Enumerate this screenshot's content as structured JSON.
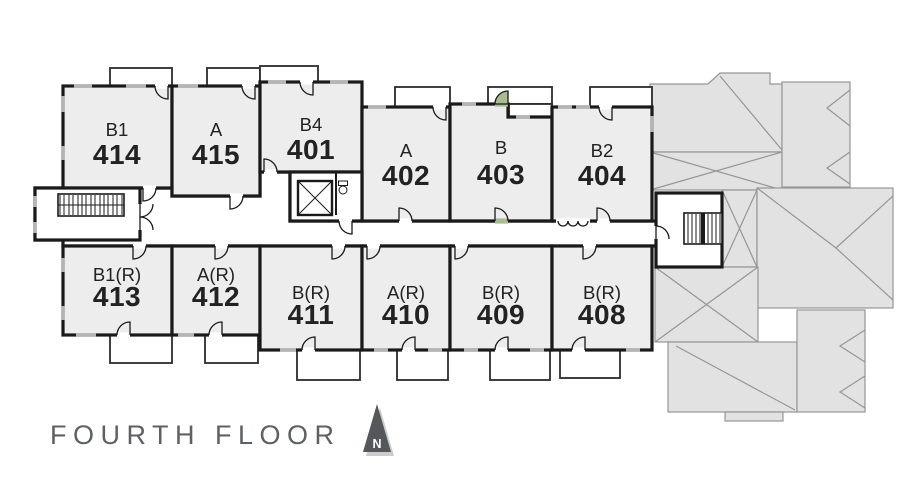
{
  "floor_plan": {
    "title": "FOURTH FLOOR",
    "compass": {
      "label": "N"
    },
    "highlighted_unit": "403",
    "colors": {
      "highlight_fill": "#a9bb90",
      "room_fill": "#ededee",
      "wall": "#1a1a1a",
      "roof_fill": "#e2e2e3",
      "title_text": "#5d6164"
    },
    "units": {
      "top_row": [
        {
          "type": "B1",
          "number": "414"
        },
        {
          "type": "A",
          "number": "415"
        },
        {
          "type": "B4",
          "number": "401"
        },
        {
          "type": "A",
          "number": "402"
        },
        {
          "type": "B",
          "number": "403",
          "highlighted": true
        },
        {
          "type": "B2",
          "number": "404"
        }
      ],
      "bottom_row": [
        {
          "type": "B1(R)",
          "number": "413"
        },
        {
          "type": "A(R)",
          "number": "412"
        },
        {
          "type": "B(R)",
          "number": "411"
        },
        {
          "type": "A(R)",
          "number": "410"
        },
        {
          "type": "B(R)",
          "number": "409"
        },
        {
          "type": "B(R)",
          "number": "408"
        }
      ]
    }
  }
}
